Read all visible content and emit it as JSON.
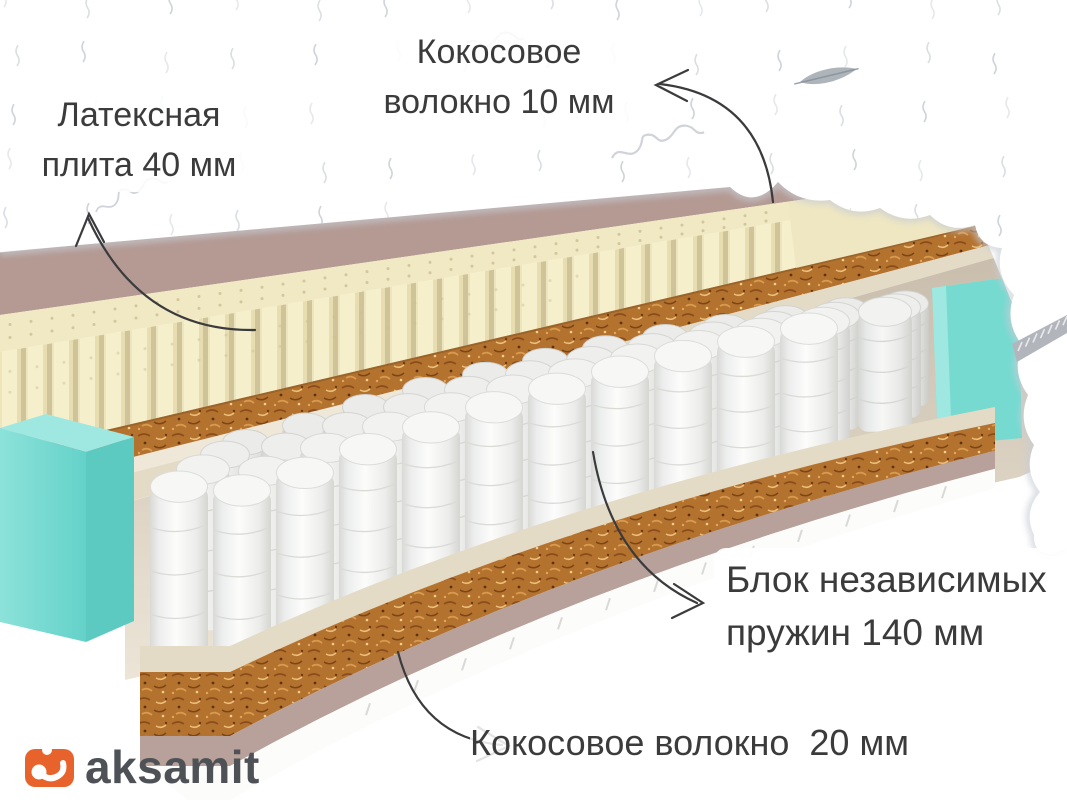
{
  "page": {
    "background_color": "#ffffff",
    "width_px": 1067,
    "height_px": 800
  },
  "diagram": {
    "type": "mattress-layer-cutaway",
    "labels": [
      {
        "id": "latex-plate",
        "lines": [
          "Латексная",
          "плита 40 мм"
        ]
      },
      {
        "id": "coconut-fiber-top",
        "lines": [
          "Кокосовое",
          "волокно 10 мм"
        ]
      },
      {
        "id": "independent-spring-block",
        "lines": [
          "Блок независимых",
          "пружин 140 мм"
        ]
      },
      {
        "id": "coconut-fiber-bottom",
        "lines": [
          "Кокосовое волокно  20 мм"
        ]
      }
    ],
    "layers": [
      {
        "name": "quilted-cover",
        "color": "#ffffff"
      },
      {
        "name": "latex-plate",
        "thickness_label": "40 мм",
        "color": "#f6efcb"
      },
      {
        "name": "coconut-fiber-top",
        "thickness_label": "10 мм",
        "color": "#b4722f"
      },
      {
        "name": "felt-pad",
        "color": "#e4dbc6"
      },
      {
        "name": "independent-springs",
        "thickness_label": "140 мм",
        "color": "#f7f8f6"
      },
      {
        "name": "side-support-foam",
        "color": "#76dad1"
      },
      {
        "name": "coconut-fiber-bottom",
        "thickness_label": "20 мм",
        "color": "#b4722f"
      },
      {
        "name": "base-fabric",
        "color": "#b49a93"
      }
    ],
    "colors": {
      "latex": "#f6efcb",
      "latex_top": "#f1e9c4",
      "latex_end": "#efe7c2",
      "coconut": "#b4722f",
      "felt": "#e4dbc6",
      "felt_light": "#efe8d8",
      "fabric_mauve": "#b49a93",
      "fabric_mauve_dark": "#b7a19a",
      "base_white": "#fcfcfb",
      "spring_white": "#f7f8f6",
      "teal": "#76dad1",
      "teal_dark": "#5ccac1",
      "teal_light": "#9fe8e1",
      "zipper": "#b2b6bc",
      "arrow": "#3b3b3d",
      "text": "#3b3b3b"
    }
  },
  "logo": {
    "brand": "aksamit",
    "accent_color": "#e8632c",
    "text_color": "#4e5257"
  }
}
